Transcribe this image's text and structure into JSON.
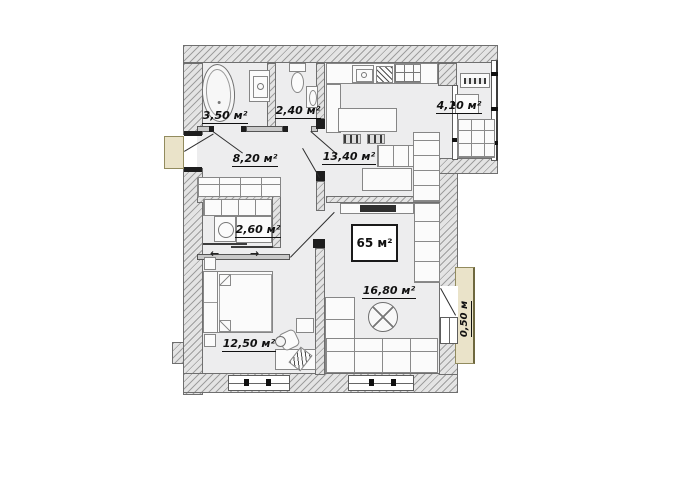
{
  "plan_type": "apartment floor plan",
  "total_area_label": "65 м²",
  "rooms": [
    {
      "id": "bathroom",
      "area_label": "3,50 м²"
    },
    {
      "id": "wc",
      "area_label": "2,40 м²"
    },
    {
      "id": "loggia",
      "area_label": "4,10 м²"
    },
    {
      "id": "hallway",
      "area_label": "8,20 м²"
    },
    {
      "id": "kitchen-living",
      "area_label": "13,40 м²"
    },
    {
      "id": "wardrobe",
      "area_label": "2,60 м²"
    },
    {
      "id": "bedroom",
      "area_label": "12,50 м²"
    },
    {
      "id": "living-room",
      "area_label": "16,80 м²"
    },
    {
      "id": "balcony",
      "area_label": "0,50 м"
    }
  ],
  "wardrobe_arrows": {
    "left": "←",
    "right": "→"
  },
  "colors": {
    "background": "#ffffff",
    "floor": "#ededee",
    "wall_fill": "#e4e4e4",
    "wall_hatch": "#9e9e9e",
    "balcony_fill": "#eae3c9",
    "label_text": "#111111",
    "line": "#555555"
  }
}
